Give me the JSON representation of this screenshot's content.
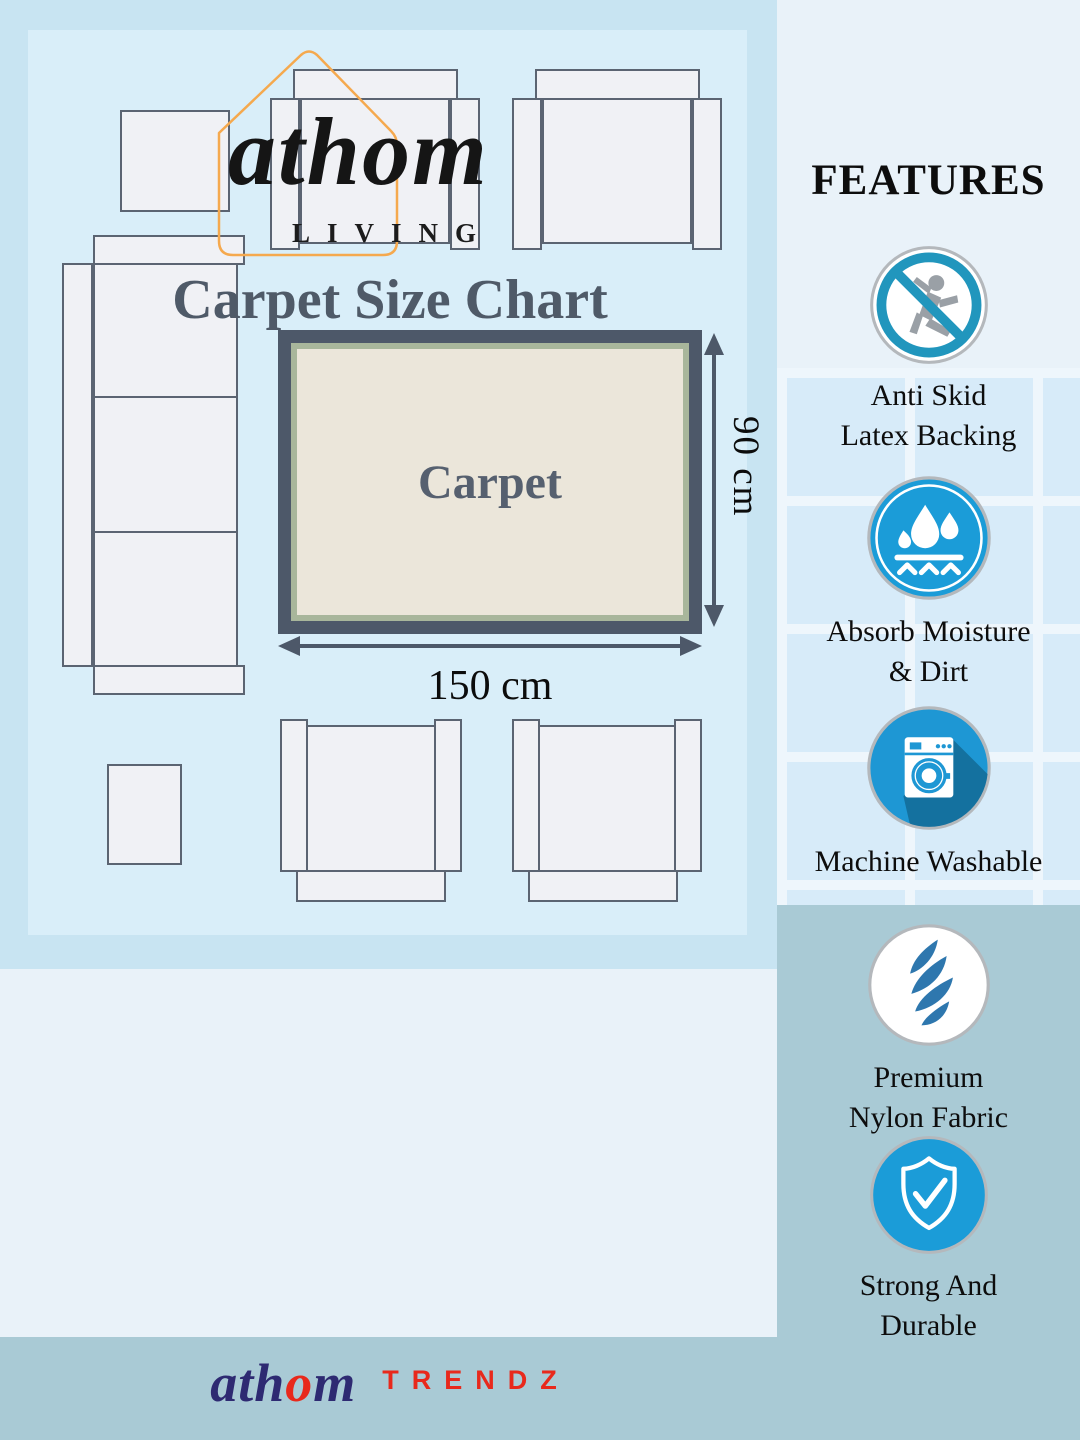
{
  "header": {
    "brand_script": "athom",
    "brand_sub": "LIVING",
    "title": "Carpet Size Chart"
  },
  "features": {
    "heading": "FEATURES",
    "items": [
      {
        "icon": "no-slip-icon",
        "line1": "Anti Skid",
        "line2": "Latex Backing"
      },
      {
        "icon": "water-drops-icon",
        "line1": "Absorb Moisture",
        "line2": "& Dirt"
      },
      {
        "icon": "washing-machine-icon",
        "line1": "Machine Washable",
        "line2": ""
      },
      {
        "icon": "fabric-swirl-icon",
        "line1": "Premium",
        "line2": "Nylon Fabric"
      },
      {
        "icon": "shield-check-icon",
        "line1": "Strong And",
        "line2": "Durable"
      }
    ]
  },
  "diagram": {
    "carpet_label": "Carpet",
    "width_label": "150 cm",
    "height_label": "90 cm"
  },
  "footer": {
    "brand_script_pre": "ath",
    "brand_script_o": "o",
    "brand_script_post": "m",
    "brand_sub": "TRENDZ"
  },
  "colors": {
    "accent_blue": "#1b9cd8",
    "ring_blue": "#2196bd",
    "swirl_blue": "#2e77ae",
    "carpet_border": "#4d5869",
    "carpet_inner_border": "#a8b69b",
    "carpet_fill": "#ebe6da",
    "footer_navy": "#2e2a72",
    "brand_red": "#e8291c",
    "house_orange": "#f5a94e",
    "panel_blue": "#a9cad5"
  }
}
